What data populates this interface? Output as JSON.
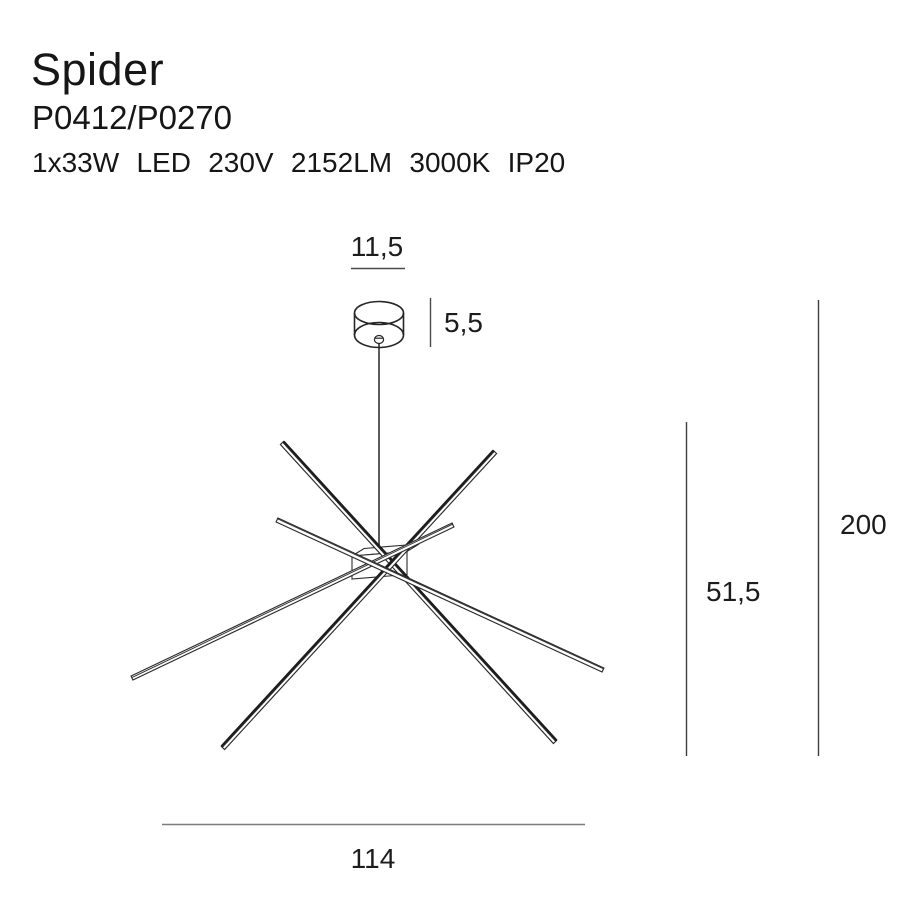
{
  "header": {
    "title": "Spider",
    "model": "P0412/P0270",
    "specs": "1x33W LED 230V 2152LM 3000K IP20"
  },
  "dimensions": {
    "canopy_diameter": "11,5",
    "canopy_height": "5,5",
    "fixture_height": "51,5",
    "total_height": "200",
    "fixture_width": "114"
  },
  "colors": {
    "ink": "#262626",
    "rod_edge": "#1c1c1c",
    "dim_line": "#4a4a4a",
    "width_dim_line": "#7d7d7d"
  }
}
